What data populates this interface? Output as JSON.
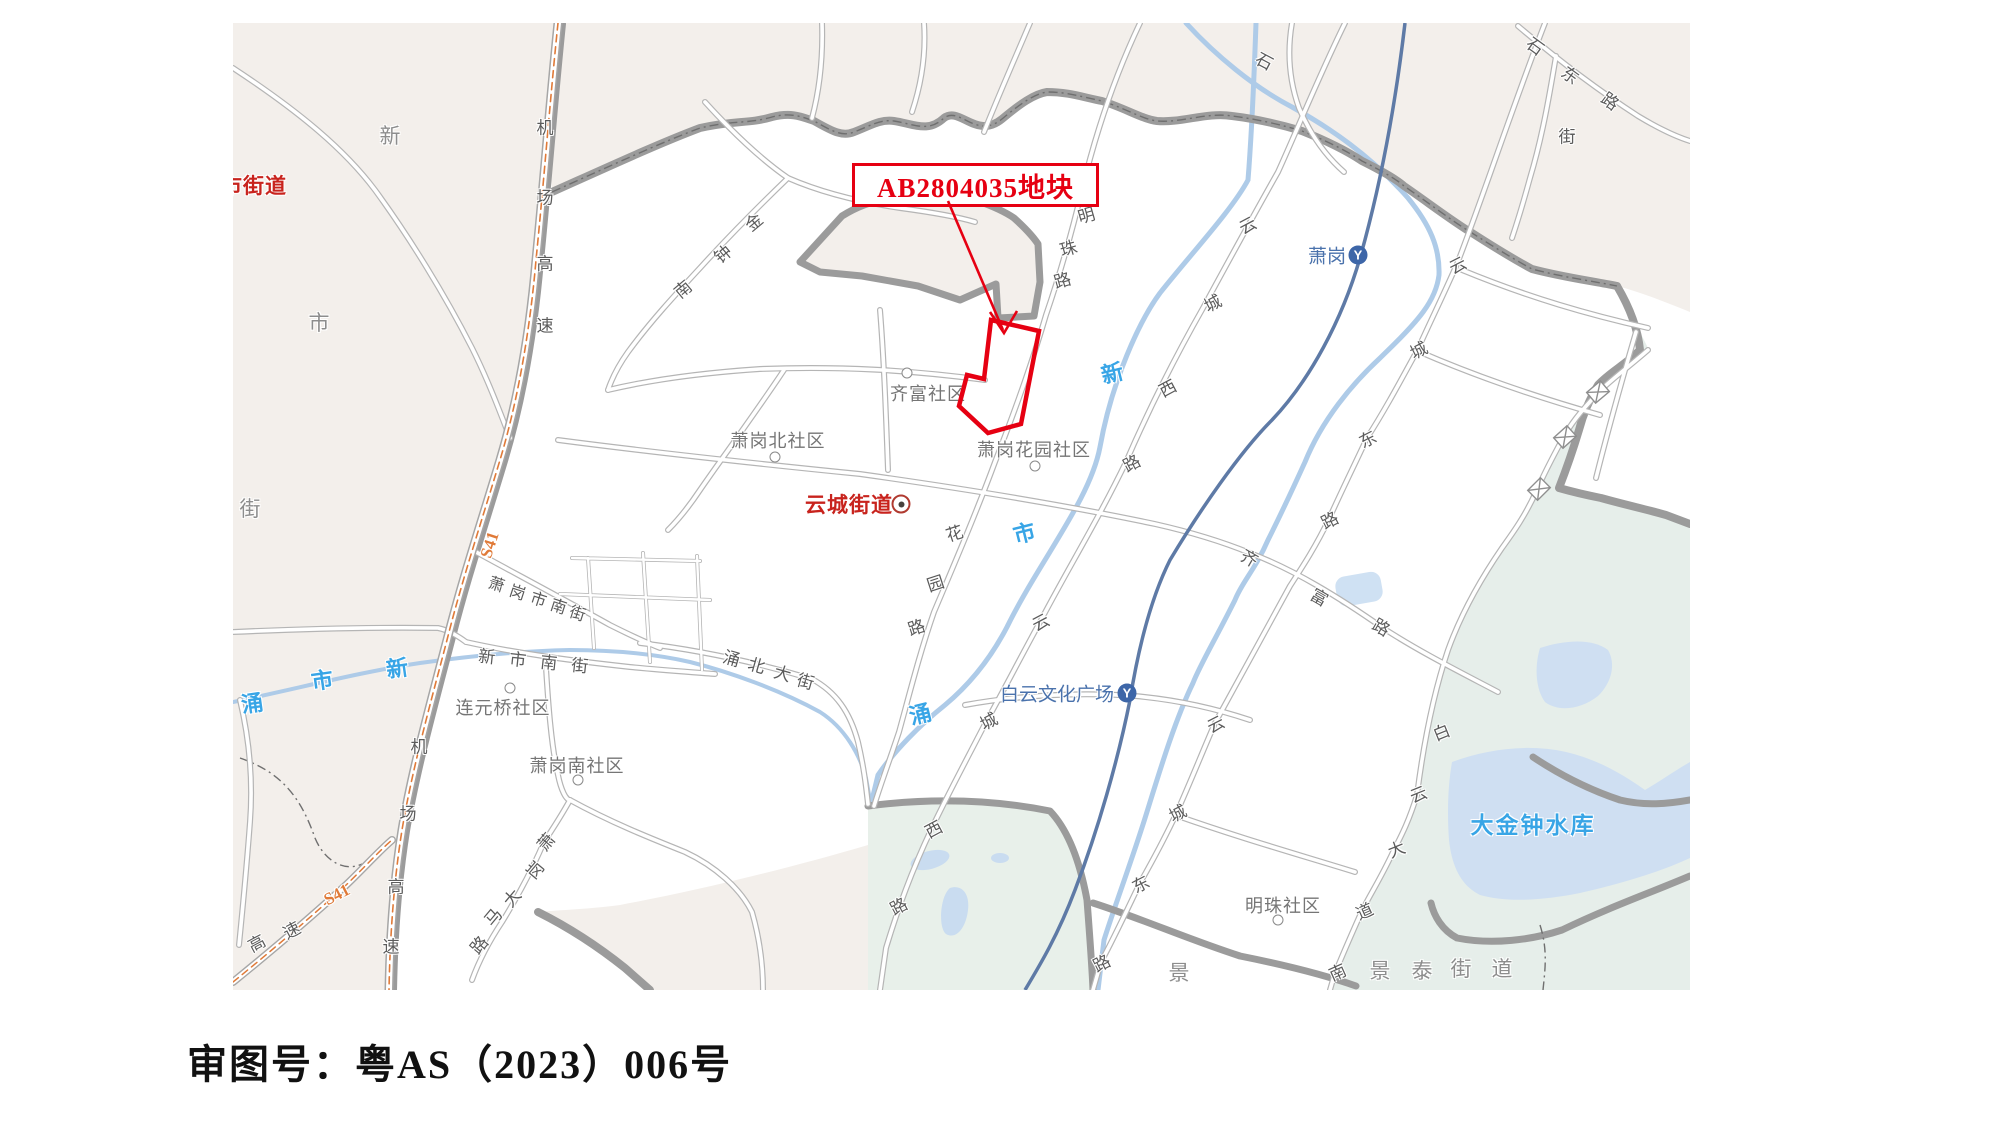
{
  "caption": "审图号：粤AS（2023）006号",
  "callout": {
    "text": "AB2804035地块"
  },
  "colors": {
    "parcel_red": "#e60012",
    "district_red": "#c8231d",
    "water_blue": "#38a5e6",
    "station_blue": "#4a72ac",
    "highway_orange": "#e07a38",
    "boundary_gray": "#9b9b9b",
    "beige": "#f3efeb",
    "teal": "#e6eeea",
    "lake": "#cfdff2"
  },
  "map": {
    "origin": {
      "x": 233,
      "y": 23
    },
    "red_districts": [
      {
        "t": "新市街道",
        "x": 243,
        "y": 185
      },
      {
        "t": "云城街道",
        "x": 849,
        "y": 504
      }
    ],
    "district_markers": [
      {
        "x": 901,
        "y": 504
      }
    ],
    "district_chars": [
      {
        "c": "新",
        "x": 390,
        "y": 135
      },
      {
        "c": "市",
        "x": 319,
        "y": 322
      },
      {
        "c": "街",
        "x": 250,
        "y": 508
      },
      {
        "c": "景",
        "x": 1179,
        "y": 972
      },
      {
        "c": "景",
        "x": 1380,
        "y": 970
      },
      {
        "c": "泰",
        "x": 1422,
        "y": 970
      },
      {
        "c": "街",
        "x": 1461,
        "y": 968
      },
      {
        "c": "道",
        "x": 1502,
        "y": 968
      }
    ],
    "communities": [
      {
        "t": "齐富社区",
        "x": 928,
        "y": 393
      },
      {
        "t": "萧岗北社区",
        "x": 778,
        "y": 440
      },
      {
        "t": "萧岗花园社区",
        "x": 1034,
        "y": 449
      },
      {
        "t": "连元桥社区",
        "x": 503,
        "y": 707
      },
      {
        "t": "萧岗南社区",
        "x": 577,
        "y": 765
      },
      {
        "t": "明珠社区",
        "x": 1283,
        "y": 905
      }
    ],
    "community_markers": [
      {
        "x": 907,
        "y": 373
      },
      {
        "x": 775,
        "y": 457
      },
      {
        "x": 1035,
        "y": 466
      },
      {
        "x": 510,
        "y": 688
      },
      {
        "x": 578,
        "y": 780
      },
      {
        "x": 1278,
        "y": 920
      }
    ],
    "stations": [
      {
        "t": "萧岗",
        "x": 1327,
        "y": 255,
        "lx": 1358,
        "ly": 255
      },
      {
        "t": "白云文化广场",
        "x": 1057,
        "y": 693,
        "lx": 1127,
        "ly": 693
      }
    ],
    "road_chars": [
      {
        "c": "机",
        "x": 545,
        "y": 126,
        "r": 0
      },
      {
        "c": "场",
        "x": 545,
        "y": 196,
        "r": 0
      },
      {
        "c": "高",
        "x": 545,
        "y": 262,
        "r": 0
      },
      {
        "c": "速",
        "x": 545,
        "y": 324,
        "r": 0
      },
      {
        "c": "机",
        "x": 419,
        "y": 745,
        "r": 0
      },
      {
        "c": "场",
        "x": 408,
        "y": 812,
        "r": 0
      },
      {
        "c": "高",
        "x": 396,
        "y": 885,
        "r": 0
      },
      {
        "c": "速",
        "x": 391,
        "y": 945,
        "r": 0
      },
      {
        "c": "高",
        "x": 256,
        "y": 942,
        "r": -28
      },
      {
        "c": "速",
        "x": 291,
        "y": 929,
        "r": -28
      },
      {
        "c": "金",
        "x": 753,
        "y": 221,
        "r": -40
      },
      {
        "c": "钟",
        "x": 722,
        "y": 253,
        "r": -40
      },
      {
        "c": "南",
        "x": 682,
        "y": 288,
        "r": -40
      },
      {
        "c": "明",
        "x": 1086,
        "y": 214,
        "r": -16
      },
      {
        "c": "珠",
        "x": 1068,
        "y": 247,
        "r": -16
      },
      {
        "c": "路",
        "x": 1062,
        "y": 279,
        "r": -16
      },
      {
        "c": "花",
        "x": 954,
        "y": 532,
        "r": -18
      },
      {
        "c": "园",
        "x": 935,
        "y": 582,
        "r": -18
      },
      {
        "c": "路",
        "x": 916,
        "y": 626,
        "r": -18
      },
      {
        "c": "云",
        "x": 1247,
        "y": 224,
        "r": -28
      },
      {
        "c": "城",
        "x": 1212,
        "y": 302,
        "r": -28
      },
      {
        "c": "西",
        "x": 1167,
        "y": 387,
        "r": -28
      },
      {
        "c": "路",
        "x": 1131,
        "y": 462,
        "r": -28
      },
      {
        "c": "云",
        "x": 1040,
        "y": 621,
        "r": -28
      },
      {
        "c": "城",
        "x": 988,
        "y": 720,
        "r": -28
      },
      {
        "c": "西",
        "x": 933,
        "y": 828,
        "r": -28
      },
      {
        "c": "路",
        "x": 898,
        "y": 905,
        "r": -28
      },
      {
        "c": "云",
        "x": 1457,
        "y": 264,
        "r": -27
      },
      {
        "c": "城",
        "x": 1418,
        "y": 349,
        "r": -27
      },
      {
        "c": "东",
        "x": 1367,
        "y": 438,
        "r": -27
      },
      {
        "c": "路",
        "x": 1329,
        "y": 519,
        "r": -27
      },
      {
        "c": "云",
        "x": 1215,
        "y": 723,
        "r": -27
      },
      {
        "c": "城",
        "x": 1177,
        "y": 812,
        "r": -27
      },
      {
        "c": "东",
        "x": 1140,
        "y": 883,
        "r": -27
      },
      {
        "c": "路",
        "x": 1101,
        "y": 962,
        "r": -27
      },
      {
        "c": "齐",
        "x": 1250,
        "y": 557,
        "r": 30
      },
      {
        "c": "富",
        "x": 1320,
        "y": 596,
        "r": 30
      },
      {
        "c": "路",
        "x": 1382,
        "y": 626,
        "r": 30
      },
      {
        "c": "白",
        "x": 1441,
        "y": 731,
        "r": -22
      },
      {
        "c": "云",
        "x": 1418,
        "y": 793,
        "r": -22
      },
      {
        "c": "大",
        "x": 1396,
        "y": 848,
        "r": -22
      },
      {
        "c": "道",
        "x": 1364,
        "y": 910,
        "r": -24
      },
      {
        "c": "南",
        "x": 1337,
        "y": 971,
        "r": -24
      },
      {
        "c": "石",
        "x": 1536,
        "y": 45,
        "r": 36
      },
      {
        "c": "东",
        "x": 1571,
        "y": 74,
        "r": 36
      },
      {
        "c": "路",
        "x": 1611,
        "y": 100,
        "r": 36
      },
      {
        "c": "石",
        "x": 1265,
        "y": 60,
        "r": 28
      },
      {
        "c": "街",
        "x": 1567,
        "y": 135,
        "r": 0
      },
      {
        "c": "萧",
        "x": 545,
        "y": 841,
        "r": -50
      },
      {
        "c": "岗",
        "x": 534,
        "y": 869,
        "r": -50
      },
      {
        "c": "大",
        "x": 511,
        "y": 897,
        "r": -50
      },
      {
        "c": "马",
        "x": 492,
        "y": 916,
        "r": -50
      },
      {
        "c": "路",
        "x": 478,
        "y": 944,
        "r": -50
      },
      {
        "c": "萧",
        "x": 497,
        "y": 583,
        "r": 18,
        "s": 16
      },
      {
        "c": "岗",
        "x": 518,
        "y": 591,
        "r": 18,
        "s": 16
      },
      {
        "c": "市",
        "x": 539,
        "y": 598,
        "r": 18,
        "s": 16
      },
      {
        "c": "南",
        "x": 559,
        "y": 605,
        "r": 18,
        "s": 16
      },
      {
        "c": "街",
        "x": 578,
        "y": 612,
        "r": 18,
        "s": 16
      },
      {
        "c": "新",
        "x": 487,
        "y": 655,
        "r": 6
      },
      {
        "c": "市",
        "x": 518,
        "y": 658,
        "r": 6
      },
      {
        "c": "南",
        "x": 549,
        "y": 661,
        "r": 6
      },
      {
        "c": "街",
        "x": 580,
        "y": 664,
        "r": 6
      },
      {
        "c": "涌",
        "x": 732,
        "y": 657,
        "r": 16
      },
      {
        "c": "北",
        "x": 757,
        "y": 664,
        "r": 16
      },
      {
        "c": "大",
        "x": 783,
        "y": 672,
        "r": 16
      },
      {
        "c": "街",
        "x": 806,
        "y": 680,
        "r": 16
      }
    ],
    "water_chars": [
      {
        "c": "涌",
        "x": 252,
        "y": 702,
        "r": -8
      },
      {
        "c": "市",
        "x": 322,
        "y": 679,
        "r": -8
      },
      {
        "c": "新",
        "x": 397,
        "y": 667,
        "r": -8
      },
      {
        "c": "新",
        "x": 1112,
        "y": 372,
        "r": -14
      },
      {
        "c": "市",
        "x": 1024,
        "y": 532,
        "r": -14
      },
      {
        "c": "涌",
        "x": 920,
        "y": 713,
        "r": -14
      }
    ],
    "water_labels": [
      {
        "t": "大金钟水库",
        "x": 1533,
        "y": 823
      }
    ],
    "s41_labels": [
      {
        "t": "S41",
        "x": 490,
        "y": 545,
        "r": -72
      },
      {
        "t": "S41",
        "x": 337,
        "y": 895,
        "r": -27
      }
    ]
  }
}
